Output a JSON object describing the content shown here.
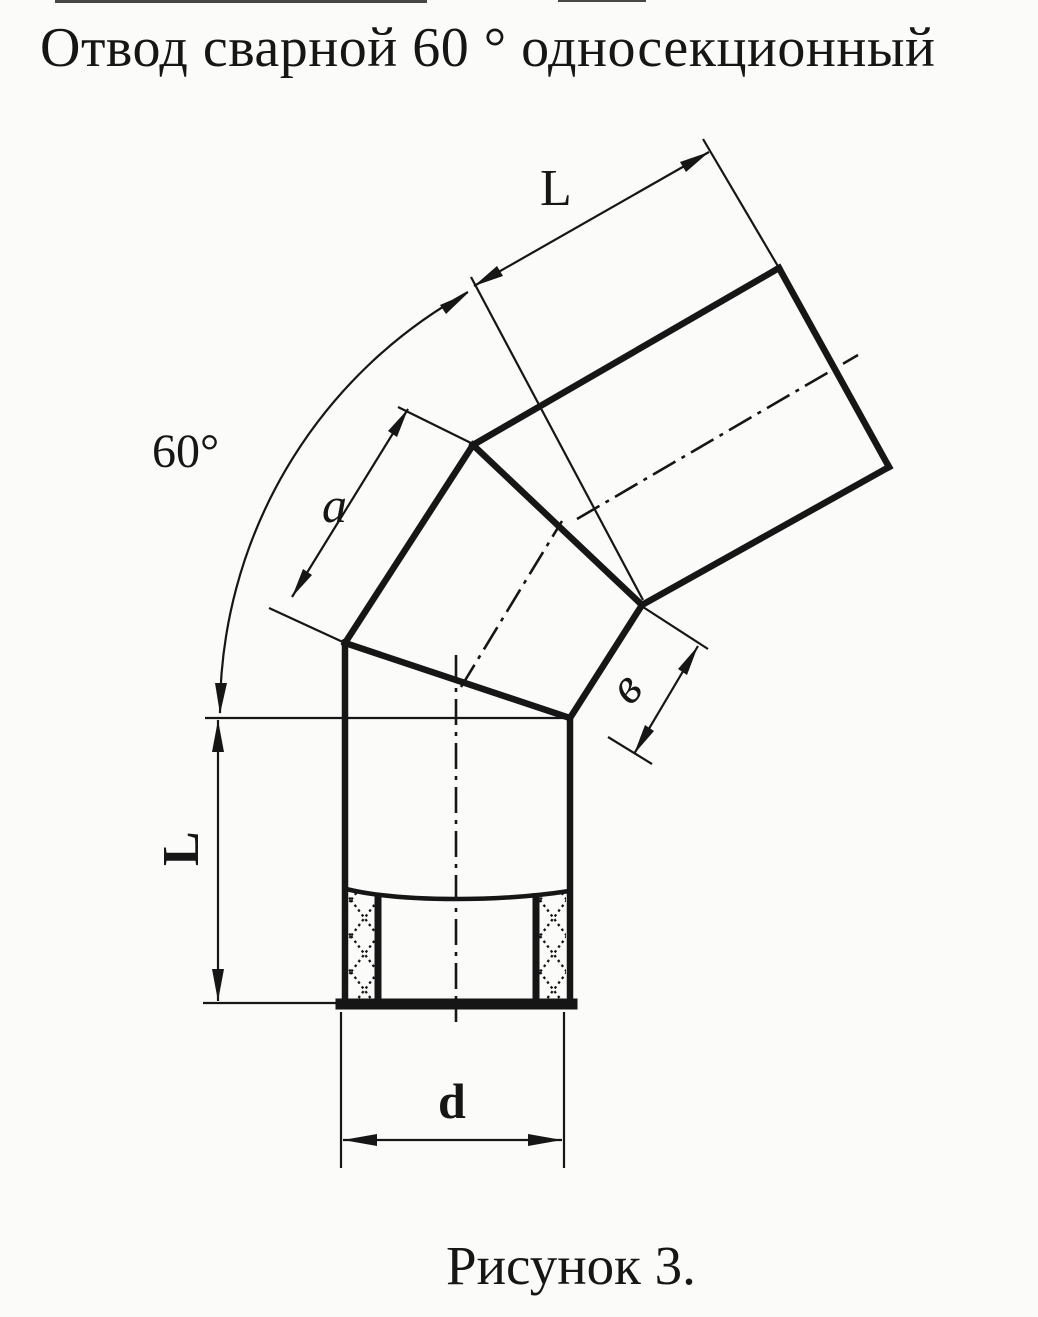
{
  "page": {
    "title": "Отвод сварной 60 ° односекционный",
    "caption": "Рисунок 3."
  },
  "drawing": {
    "subject": "welded 60-degree single-section pipe elbow",
    "labels": {
      "angle": "60°",
      "top_pipe_length": "L",
      "section_side_length": "a",
      "section_end_width": "в",
      "bottom_pipe_length": "L",
      "pipe_diameter": "d"
    }
  },
  "colors": {
    "ink": "#161616",
    "paper": "#fbfbf9"
  }
}
